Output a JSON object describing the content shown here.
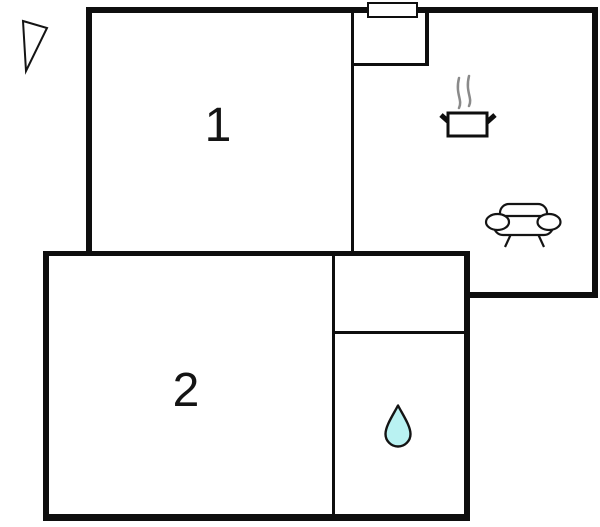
{
  "plan": {
    "type": "apartment-floor-plan",
    "room1_label": "1",
    "room2_label": "2"
  },
  "icons": {
    "north_arrow": "north-arrow",
    "cooking_pot": "cooking-pot-with-steam (kitchen)",
    "sofa": "sofa (living room)",
    "water_drop": "water-drop (bathroom)"
  },
  "colors": {
    "wall": "#0e0e0e",
    "background": "#ffffff",
    "water_drop_fill": "#b9f2f2",
    "steam_gray": "#8a8a8a"
  }
}
